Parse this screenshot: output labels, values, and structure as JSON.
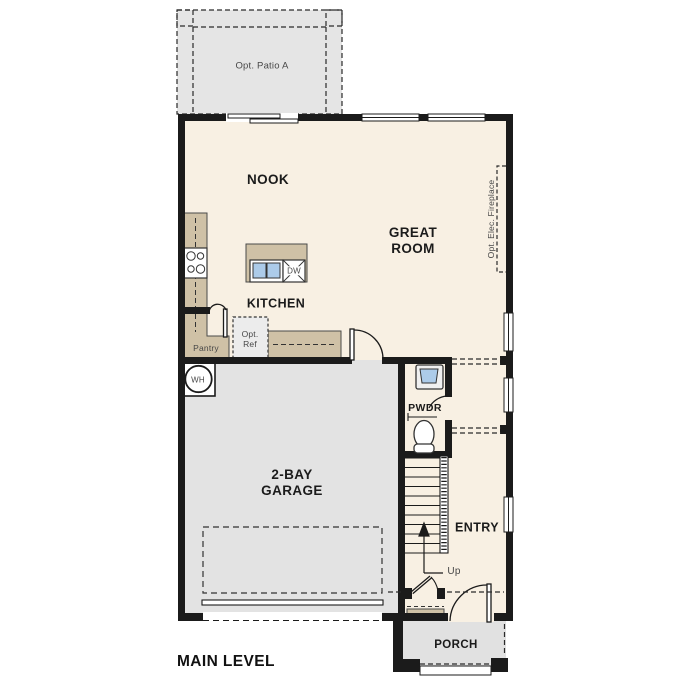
{
  "plan_title": "MAIN LEVEL",
  "colors": {
    "wall": "#1b1b1b",
    "interior": "#f8f0e3",
    "garage_fill": "#e3e3e3",
    "patio_fill": "#e5e5e5",
    "porch_fill": "#e1e1e1",
    "counter_fill": "#cfc1a6",
    "sink_fill": "#accbe9",
    "optional_box_fill": "#ececec"
  },
  "rooms": {
    "nook": "NOOK",
    "great_room": "GREAT ROOM",
    "kitchen": "KITCHEN",
    "garage": "2-BAY GARAGE",
    "powder": "PWDR",
    "entry": "ENTRY",
    "porch": "PORCH"
  },
  "annotations": {
    "patio": "Opt. Patio A",
    "fireplace": "Opt. Elec. Fireplace",
    "pantry": "Pantry",
    "opt_ref": "Opt.\nRef",
    "dishwasher": "DW",
    "water_heater": "WH",
    "stairs_up": "Up"
  }
}
